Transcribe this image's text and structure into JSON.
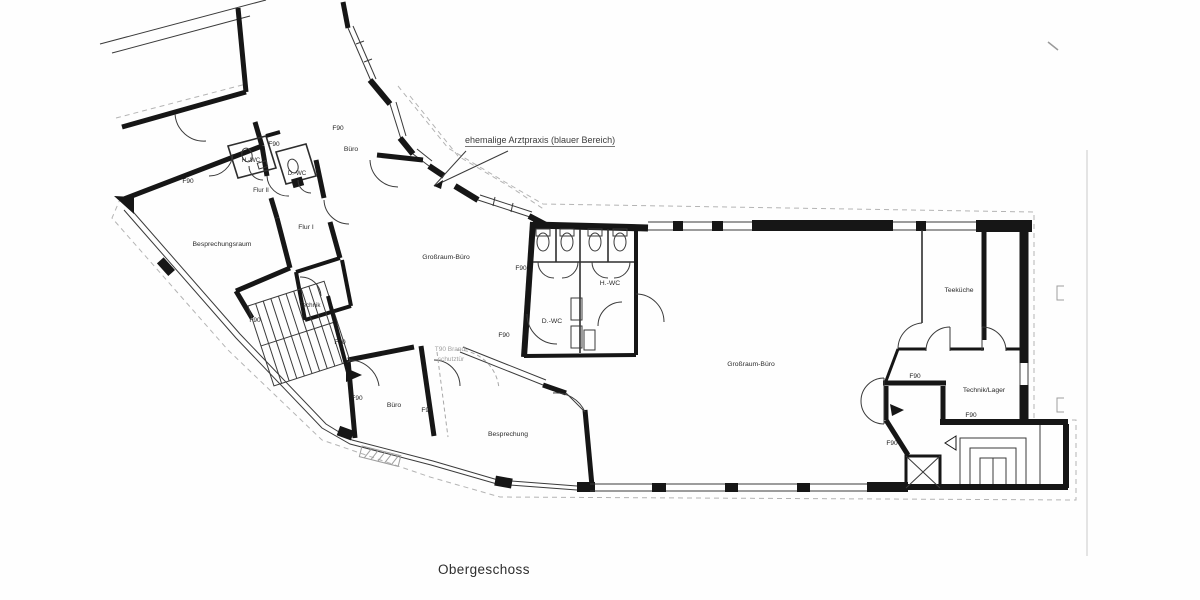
{
  "title": {
    "text": "Obergeschoss"
  },
  "annotations": {
    "former_practice": "ehemalige Arztpraxis (blauer Bereich)",
    "fire_door": {
      "line1": "T90 Brand-",
      "line2": "schutztür",
      "x": 451,
      "y1": 351,
      "y2": 361
    }
  },
  "colors": {
    "wall": "#161616",
    "thin_line": "#3a3a3a",
    "dashed_outline": "#b4b4b4",
    "gray_note": "#a0a0a0"
  },
  "rooms": [
    {
      "label": "Büro",
      "x": 351,
      "y": 151
    },
    {
      "label": "H.-WC",
      "x": 251,
      "y": 162,
      "size": 6.2
    },
    {
      "label": "D.-WC",
      "x": 297,
      "y": 175,
      "size": 6.2
    },
    {
      "label": "Flur II",
      "x": 261,
      "y": 192,
      "size": 6.2
    },
    {
      "label": "Besprechungsraum",
      "x": 222,
      "y": 246
    },
    {
      "label": "Flur I",
      "x": 306,
      "y": 229
    },
    {
      "label": "Technik",
      "x": 310,
      "y": 307,
      "size": 6.2
    },
    {
      "label": "Großraum-Büro",
      "x": 446,
      "y": 259
    },
    {
      "label": "H.-WC",
      "x": 610,
      "y": 285
    },
    {
      "label": "D.-WC",
      "x": 552,
      "y": 323
    },
    {
      "label": "Großraum-Büro",
      "x": 751,
      "y": 366
    },
    {
      "label": "Teeküche",
      "x": 959,
      "y": 292
    },
    {
      "label": "Technik/Lager",
      "x": 984,
      "y": 392
    },
    {
      "label": "Besprechung",
      "x": 508,
      "y": 436
    },
    {
      "label": "Büro",
      "x": 394,
      "y": 407
    }
  ],
  "fire_labels": [
    {
      "text": "F90",
      "x": 274,
      "y": 146
    },
    {
      "text": "F90",
      "x": 188,
      "y": 183
    },
    {
      "text": "F90",
      "x": 338,
      "y": 130
    },
    {
      "text": "F90",
      "x": 255,
      "y": 322
    },
    {
      "text": "F90",
      "x": 340,
      "y": 344
    },
    {
      "text": "F90",
      "x": 357,
      "y": 400
    },
    {
      "text": "F90",
      "x": 427,
      "y": 412
    },
    {
      "text": "F90",
      "x": 504,
      "y": 337
    },
    {
      "text": "F90",
      "x": 521,
      "y": 270
    },
    {
      "text": "F90",
      "x": 915,
      "y": 378
    },
    {
      "text": "F90",
      "x": 971,
      "y": 417
    },
    {
      "text": "F90",
      "x": 892,
      "y": 445
    }
  ]
}
